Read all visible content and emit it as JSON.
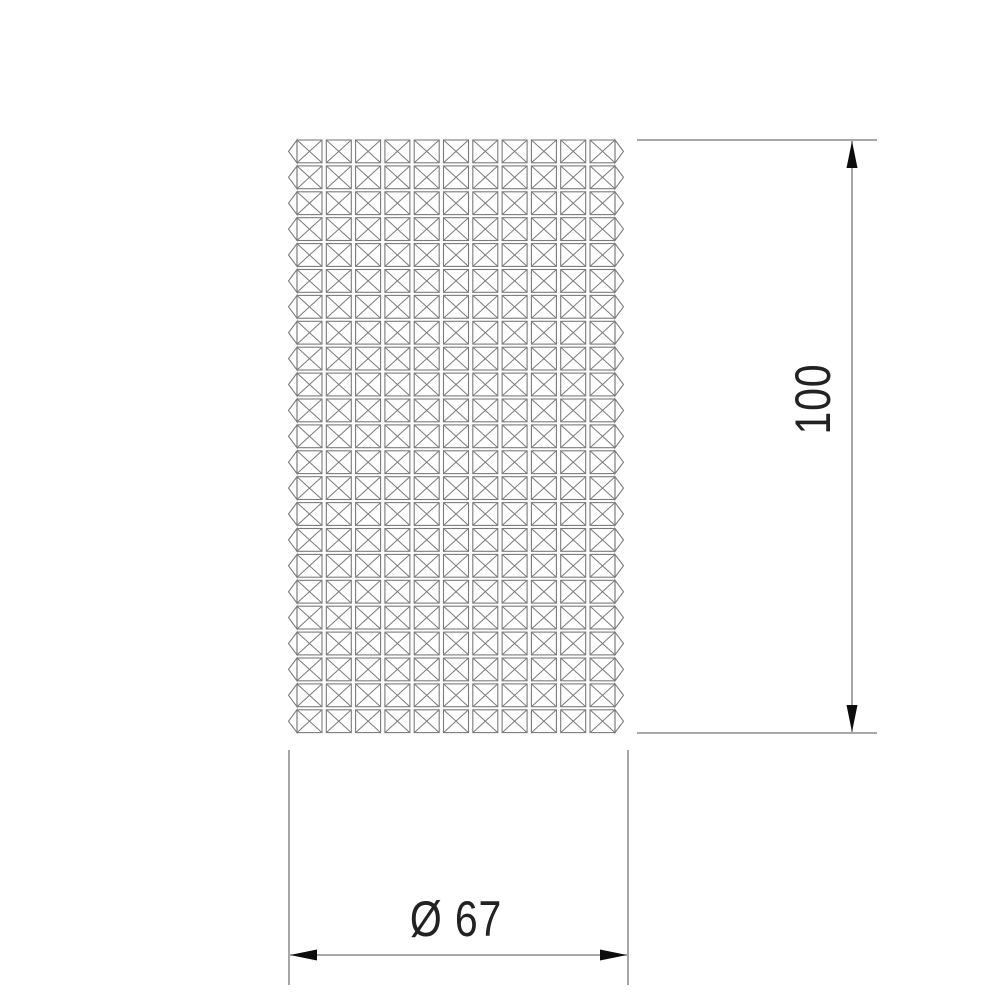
{
  "drawing": {
    "view": "crystal-cylinder-front-view",
    "background": "#ffffff",
    "colors": {
      "grid_line": "#7b7b7b",
      "dimension_line": "#757575",
      "arrow": "#0d0d0d",
      "text": "#222222"
    },
    "facet_grid": {
      "rows": 23,
      "columns": 11,
      "cell_motif": "square-with-x-diagonals",
      "edge_motif": "side-prism-triangles"
    }
  },
  "dimensions": {
    "height": {
      "label": "100",
      "orientation": "vertical"
    },
    "diameter": {
      "label": "Ø 67",
      "orientation": "horizontal"
    }
  }
}
